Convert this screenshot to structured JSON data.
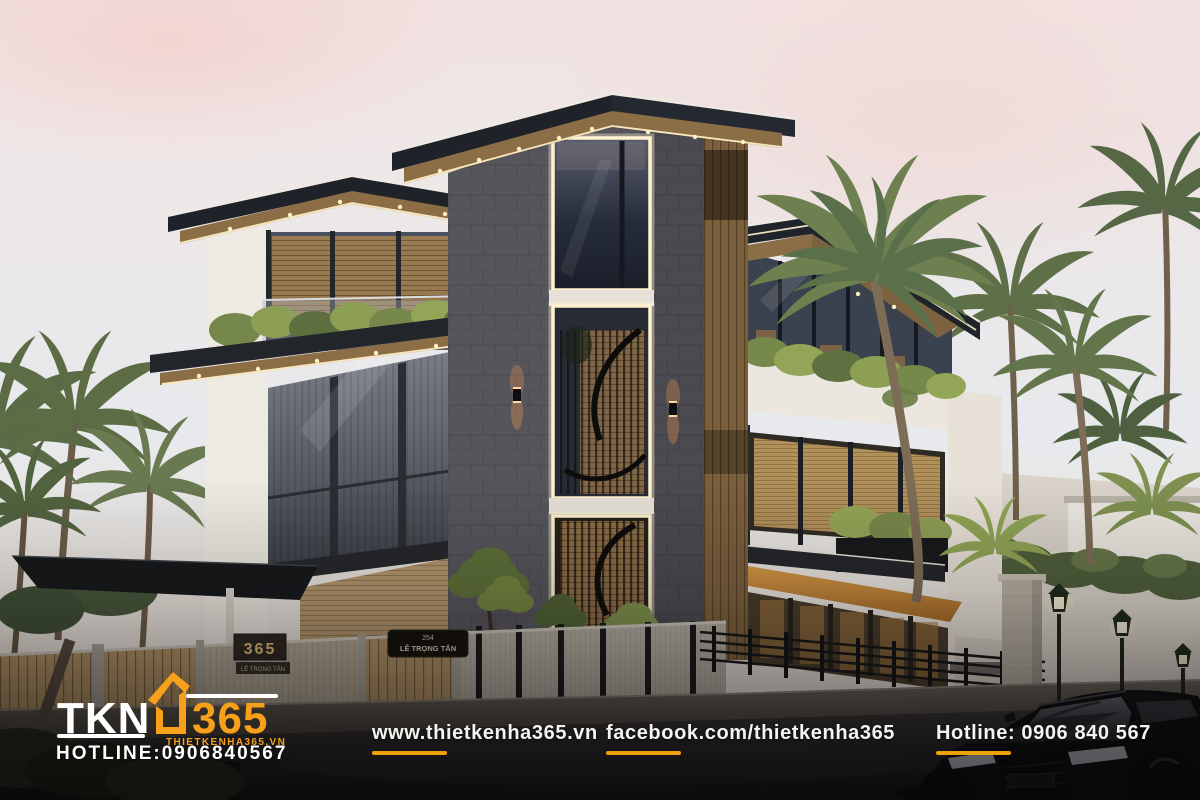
{
  "branding": {
    "logo": {
      "name": "TKN",
      "number": "365",
      "website": "THIETKENHA365.VN",
      "hotline": "HOTLINE:0906840567",
      "accent_color": "#F6A01C",
      "text_color": "#FFFFFF"
    }
  },
  "footer": {
    "website": "www.thietkenha365.vn",
    "facebook": "facebook.com/thietkenha365",
    "hotline": "Hotline: 0906 840 567",
    "underline_color": "#EFA10B",
    "text_color": "#F5F3F0"
  },
  "scene": {
    "gate_sign": {
      "number": "365",
      "street": "LÊ TRỌNG TẤN"
    },
    "address_plaque": {
      "number": "254",
      "street": "LÊ TRỌNG TẤN"
    },
    "palette": {
      "sky_pink": "#F1E1E0",
      "sky_blue": "#E7E9EC",
      "stone": "#56555C",
      "roof_dark": "#20242A",
      "wood_soffit": "#8B6D46",
      "led_glow": "#FFF3CF",
      "foliage": "#6F814C",
      "fence_wood": "#B29366",
      "canopy_orange": "#C98A3C",
      "asphalt": "#2B292B"
    }
  }
}
